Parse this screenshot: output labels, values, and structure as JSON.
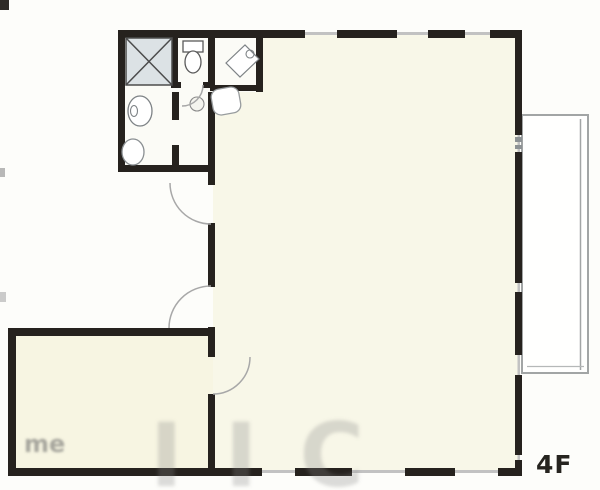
{
  "floor_plan": {
    "floor_label": "4F",
    "watermark": {
      "small": "me",
      "large": "IIC"
    },
    "colors": {
      "wall": "#26221e",
      "main_room_fill": "#f8f7e8",
      "second_room_fill": "#f7f5e2",
      "bathroom_fill": "#fbfbf6",
      "bath_unit_fill": "#dce2e5",
      "window_thin_line": "#c2c2c2",
      "balcony_outline": "#a2a5a5",
      "fixture_outline": "#7d8285",
      "door_arc": "#a8a8a8",
      "background": "#fdfdfa",
      "label_color": "#26241f"
    },
    "rooms": [
      {
        "name": "main-room"
      },
      {
        "name": "second-room"
      },
      {
        "name": "bathroom-block"
      },
      {
        "name": "balcony"
      }
    ],
    "fixtures": [
      "bathtub",
      "toilet",
      "washbasin",
      "laundry-space",
      "corner-sink",
      "kitchen-sink"
    ],
    "doors": [
      "entrance-door",
      "room-door",
      "second-room-door",
      "toilet-door"
    ]
  }
}
